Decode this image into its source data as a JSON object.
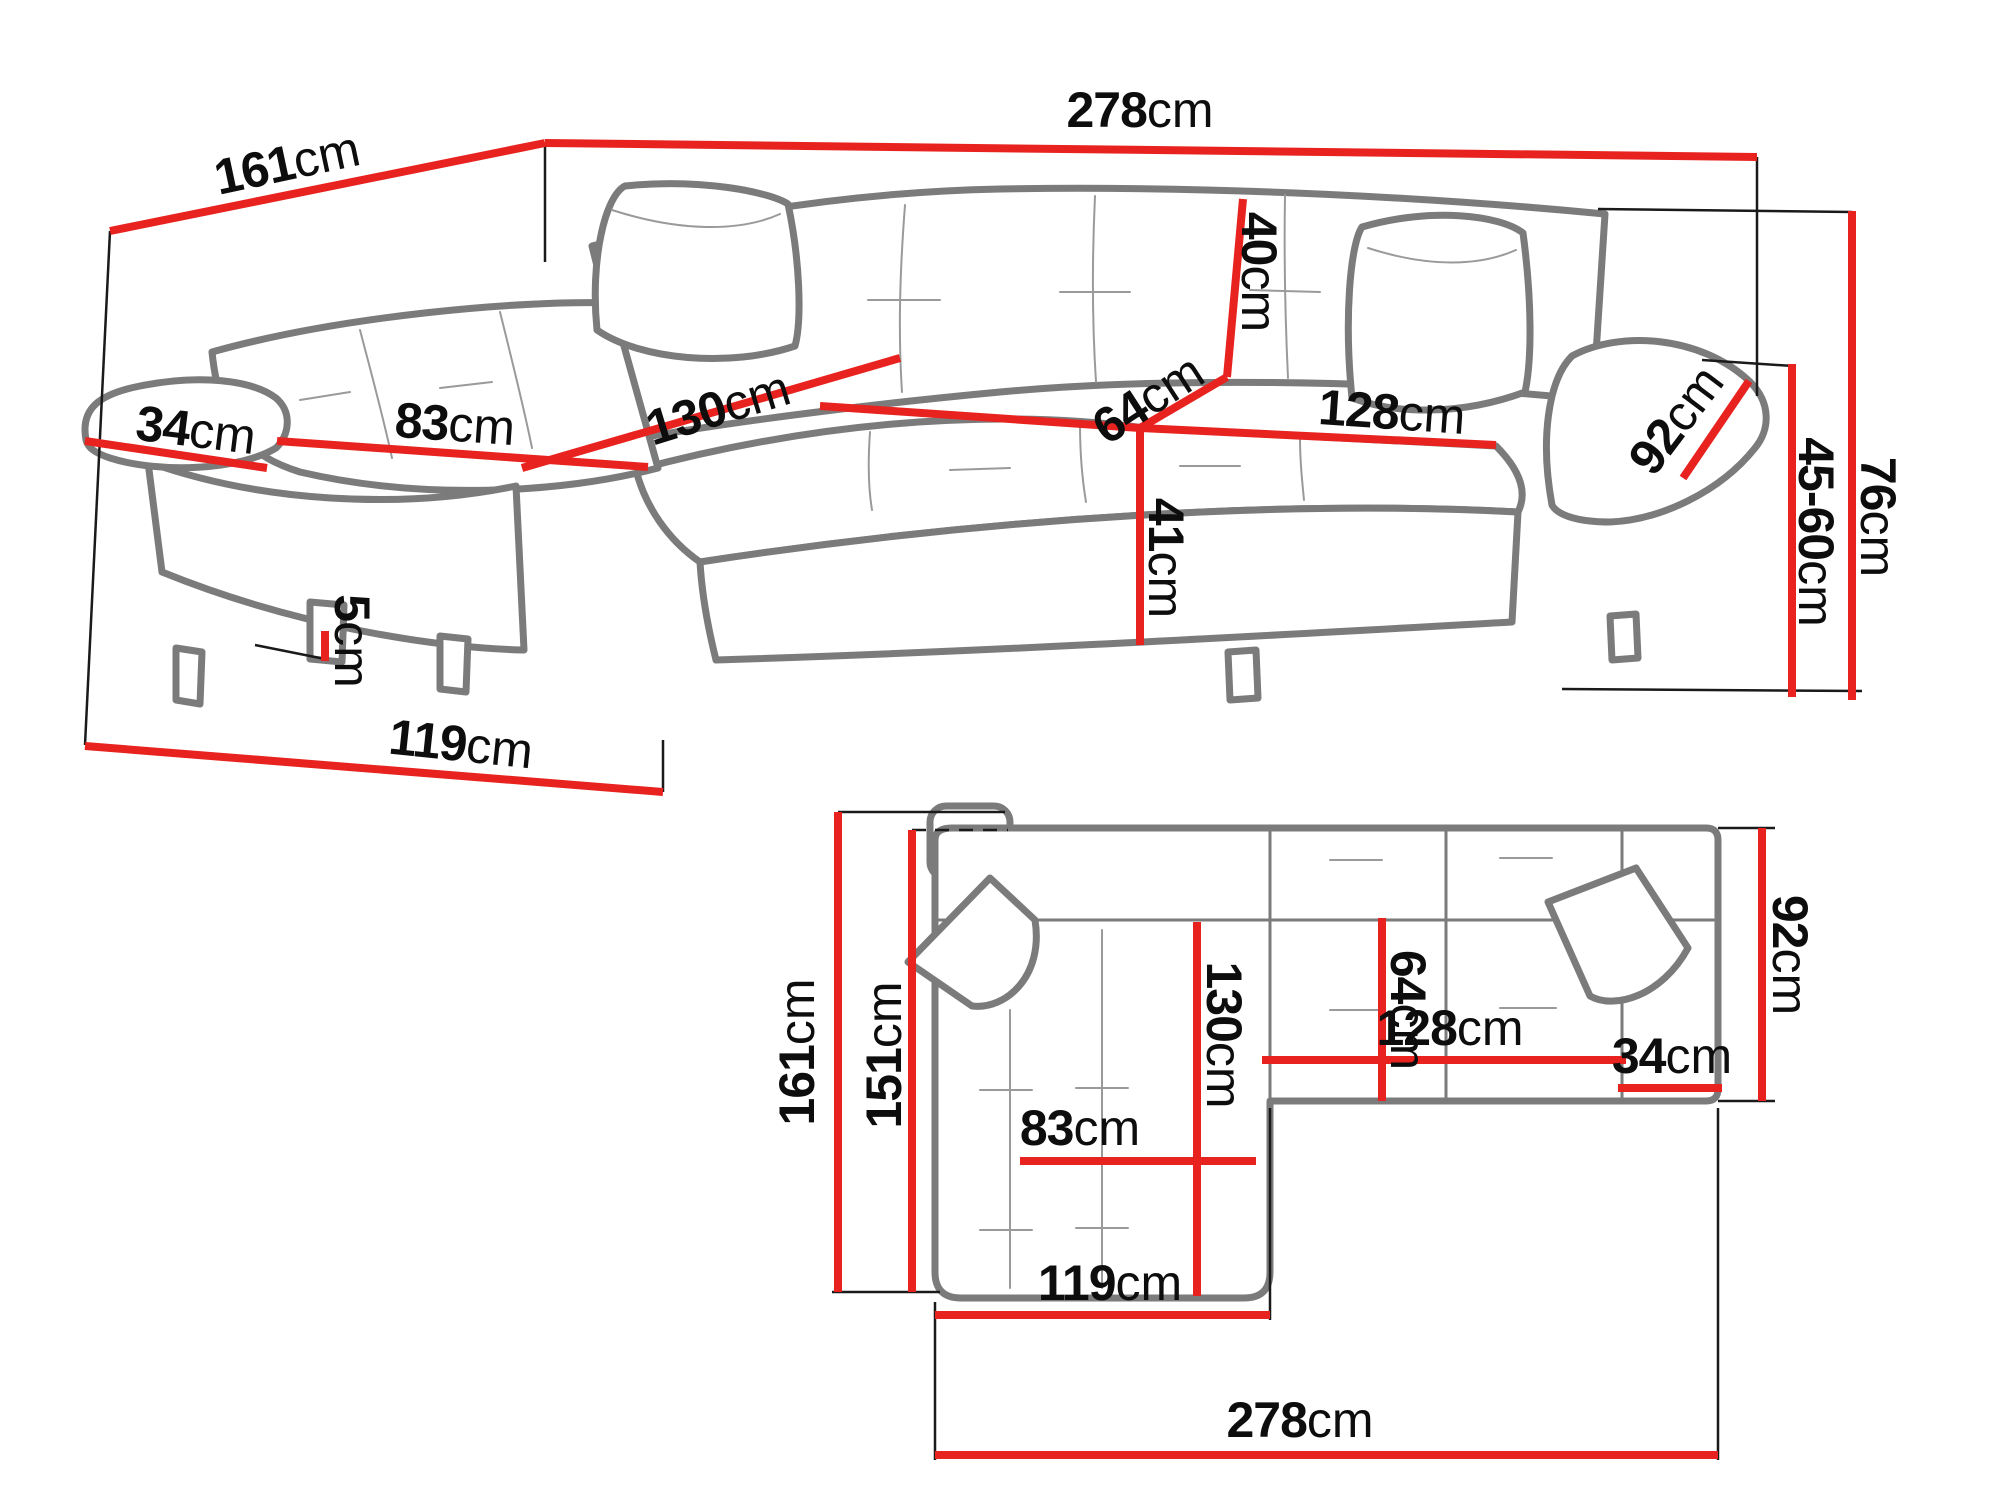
{
  "colors": {
    "dimension_line": "#e8231f",
    "sofa_outline": "#7b7b7b",
    "seam_line": "#9a9a9a",
    "extension_line": "#1a1a1a",
    "label_text": "#0d0d0d",
    "background": "#ffffff"
  },
  "labels": {
    "p278": {
      "value": "278",
      "unit": "cm"
    },
    "p161": {
      "value": "161",
      "unit": "cm"
    },
    "p34": {
      "value": "34",
      "unit": "cm"
    },
    "p83": {
      "value": "83",
      "unit": "cm"
    },
    "p130": {
      "value": "130",
      "unit": "cm"
    },
    "p40": {
      "value": "40",
      "unit": "cm"
    },
    "p64": {
      "value": "64",
      "unit": "cm"
    },
    "p128": {
      "value": "128",
      "unit": "cm"
    },
    "p92": {
      "value": "92",
      "unit": "cm"
    },
    "p41": {
      "value": "41",
      "unit": "cm"
    },
    "p76": {
      "value": "76",
      "unit": "cm"
    },
    "p4560": {
      "value": "45-60",
      "unit": "cm"
    },
    "p5": {
      "value": "5",
      "unit": "cm"
    },
    "p119": {
      "value": "119",
      "unit": "cm"
    },
    "b161": {
      "value": "161",
      "unit": "cm"
    },
    "b151": {
      "value": "151",
      "unit": "cm"
    },
    "b130": {
      "value": "130",
      "unit": "cm"
    },
    "b64": {
      "value": "64",
      "unit": "cm"
    },
    "b83": {
      "value": "83",
      "unit": "cm"
    },
    "b119": {
      "value": "119",
      "unit": "cm"
    },
    "b128": {
      "value": "128",
      "unit": "cm"
    },
    "b34": {
      "value": "34",
      "unit": "cm"
    },
    "b92": {
      "value": "92",
      "unit": "cm"
    },
    "b278": {
      "value": "278",
      "unit": "cm"
    }
  }
}
